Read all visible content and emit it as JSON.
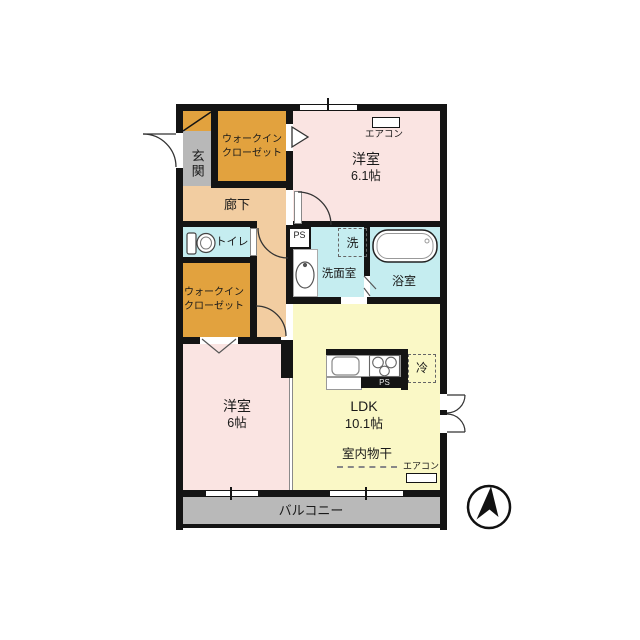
{
  "floorplan": {
    "rooms": {
      "genkan": {
        "label": "玄関"
      },
      "wic_top": {
        "label": "ウォークイン\nクローゼット"
      },
      "wic_left": {
        "label": "ウォークイン\nクローゼット"
      },
      "bedroom_top": {
        "name": "洋室",
        "size": "6.1帖"
      },
      "bedroom_left": {
        "name": "洋室",
        "size": "6帖"
      },
      "hallway": {
        "label": "廊下"
      },
      "toilet": {
        "label": "トイレ"
      },
      "washroom": {
        "label": "洗面室"
      },
      "bath": {
        "label": "浴室"
      },
      "ldk": {
        "name": "LDK",
        "size": "10.1帖"
      },
      "balcony": {
        "label": "バルコニー"
      }
    },
    "fixtures": {
      "ps_top": "PS",
      "ps_kitchen": "PS",
      "washer": "洗",
      "fridge": "冷",
      "aircon_top": "エアコン",
      "aircon_bottom": "エアコン",
      "indoor_drying": "室内物干"
    },
    "colors": {
      "wall": "#141414",
      "bedroom": "#fae4e2",
      "ldk": "#faf8c6",
      "wet_area": "#c5edf0",
      "closet": "#e2a23e",
      "hallway": "#f2cda1",
      "entrance": "#b8b8b8",
      "balcony": "#b9b9b9"
    }
  }
}
